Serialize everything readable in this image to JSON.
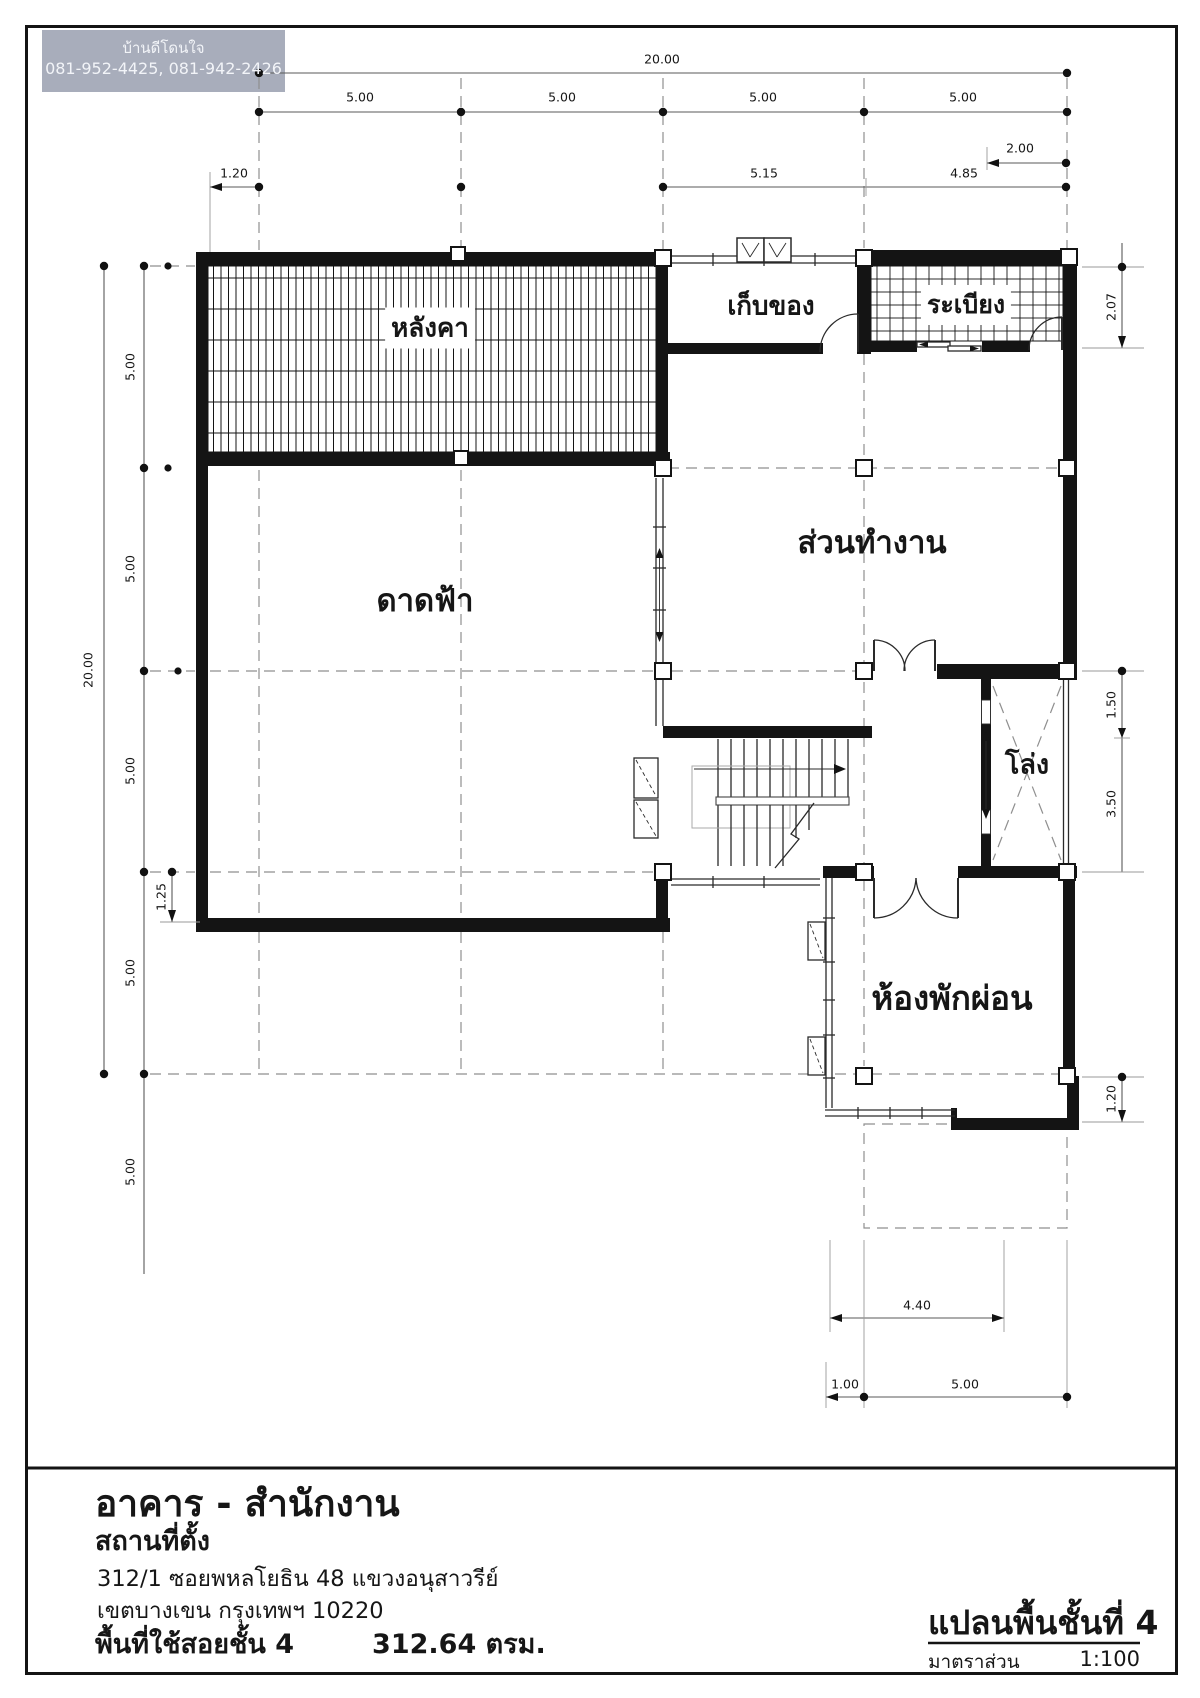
{
  "watermark": {
    "line1": "บ้านดีโดนใจ",
    "line2": "081-952-4425, 081-942-2426",
    "bg_color": "#a8adbb",
    "text_color": "#f2f4f8"
  },
  "colors": {
    "wall": "#141414",
    "thin_line": "#2a2a2a",
    "grid_dash": "#8f8f8f",
    "dim_line": "#5a5a5a",
    "text": "#161616",
    "paper": "#ffffff"
  },
  "rooms": {
    "roof": "หลังคา",
    "storage": "เก็บของ",
    "balcony": "ระเบียง",
    "work_area": "ส่วนทำงาน",
    "roof_deck": "ดาดฟ้า",
    "void": "โล่ง",
    "lounge": "ห้องพักผ่อน"
  },
  "dims": {
    "top_total": "20.00",
    "top_bays": [
      "5.00",
      "5.00",
      "5.00",
      "5.00"
    ],
    "top_right_offset": "2.00",
    "top_sub": [
      "1.20",
      "5.15",
      "4.85"
    ],
    "left_total": "20.00",
    "left_bays": [
      "5.00",
      "5.00",
      "5.00",
      "5.00",
      "5.00"
    ],
    "left_offset": "1.25",
    "right_bays": [
      "2.07",
      "1.50",
      "3.50",
      "1.20"
    ],
    "bottom_bays": [
      "4.40",
      "1.00",
      "5.00"
    ]
  },
  "title_block": {
    "project": "อาคาร - สำนักงาน",
    "location_label": "สถานที่ตั้ง",
    "address_line1": "312/1 ซอยพหลโยธิน 48 แขวงอนุสาวรีย์",
    "address_line2": "เขตบางเขน กรุงเทพฯ 10220",
    "area_label": "พื้นที่ใช้สอยชั้น 4",
    "area_value": "312.64 ตรม.",
    "plan_name": "แปลนพื้นชั้นที่ 4",
    "scale_label": "มาตราส่วน",
    "scale_value": "1:100"
  }
}
